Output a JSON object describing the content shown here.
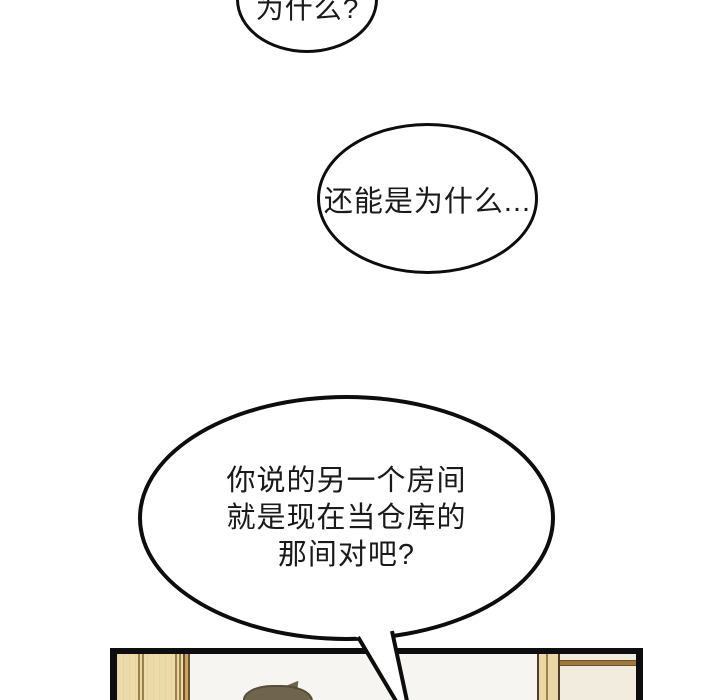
{
  "page": {
    "type": "comic-page",
    "background": "#ffffff"
  },
  "bubbles": {
    "top": {
      "text": "为什么?"
    },
    "middle": {
      "text": "还能是为什么..."
    },
    "main": {
      "lines": [
        "你说的另一个房间",
        "就是现在当仓库的",
        "那间对吧?"
      ]
    }
  },
  "panel": {
    "description": "partial room panel cut off at bottom edge",
    "elements": [
      "door-frame-left",
      "wall",
      "character-hair",
      "wood-pillar",
      "cabinet",
      "shelf-line"
    ]
  },
  "colors": {
    "ink": "#0d0d0d",
    "paper": "#ffffff",
    "text": "#1a1a1a",
    "wall": "#f6f5f2",
    "wood": "#ecdaa9",
    "wood_line": "#9b8148",
    "wood_band": "#caa365",
    "wood_band_edge": "#6a5429",
    "hair": "#6f644e",
    "hair_outline": "#554c3a",
    "post": "#ead7a5",
    "post_edge": "#4e3e28",
    "cream": "#f2ecdf",
    "shelf": "#a0773c",
    "shelf_edge": "#6d5224"
  }
}
